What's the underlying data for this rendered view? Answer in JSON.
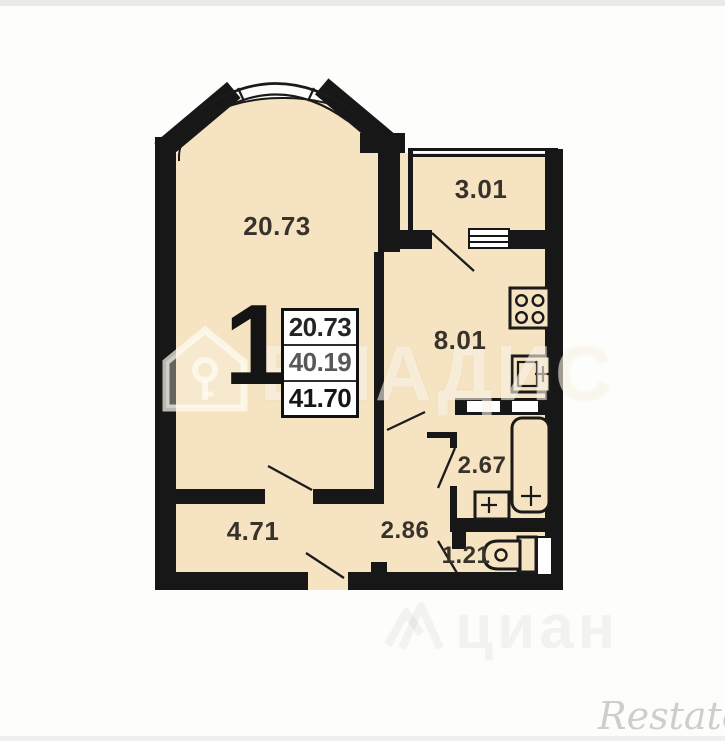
{
  "plan": {
    "unit_label": "1",
    "area_table": {
      "values": [
        "20.73",
        "40.19",
        "41.70"
      ]
    },
    "rooms": {
      "living": {
        "area": "20.73"
      },
      "balcony": {
        "area": "3.01"
      },
      "kitchen": {
        "area": "8.01"
      },
      "bathroom": {
        "area": "2.67"
      },
      "hallway": {
        "area": "4.71"
      },
      "corridor": {
        "area": "2.86"
      },
      "wc": {
        "area": "1.21"
      }
    },
    "colors": {
      "wall": "#171717",
      "floor_fill": "#f5e3c2",
      "paper": "#fdfdfb"
    }
  },
  "watermarks": {
    "vladis": "ВЛАДИС",
    "cian": "циан",
    "restate": "Restate"
  }
}
